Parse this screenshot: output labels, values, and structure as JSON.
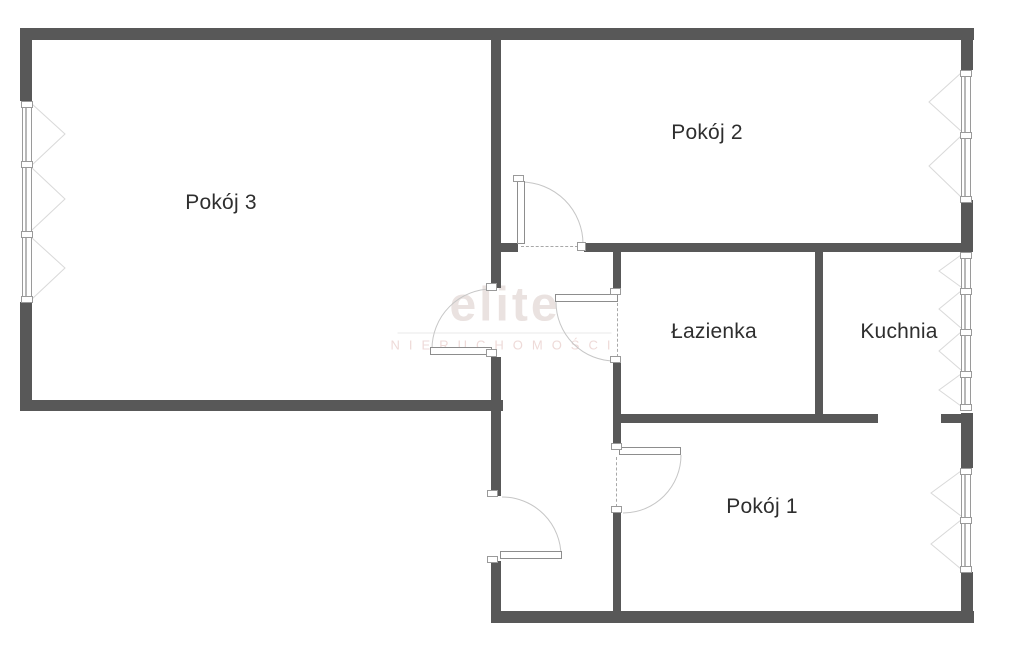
{
  "canvas": {
    "width": 1024,
    "height": 652,
    "background": "#ffffff"
  },
  "colors": {
    "wall": "#585858",
    "frame": "#9a9a9a",
    "leaf_border": "#8d8d8d",
    "door_arc": "#c6c6c6",
    "casement_line": "#d9d9d9",
    "dash": "#a8a8a8",
    "label": "#2e2e2e",
    "watermark_brand": "#eae2e0",
    "watermark_subtitle": "#eedad8",
    "watermark_line": "#e9e9e9"
  },
  "rooms": [
    {
      "id": "pokoj-3",
      "label": "Pokój 3",
      "label_x": 221,
      "label_y": 203
    },
    {
      "id": "pokoj-2",
      "label": "Pokój 2",
      "label_x": 707,
      "label_y": 133
    },
    {
      "id": "lazienka",
      "label": "Łazienka",
      "label_x": 714,
      "label_y": 332
    },
    {
      "id": "kuchnia",
      "label": "Kuchnia",
      "label_x": 899,
      "label_y": 332
    },
    {
      "id": "pokoj-1",
      "label": "Pokój 1",
      "label_x": 762,
      "label_y": 507
    }
  ],
  "watermark": {
    "brand": "elite",
    "subtitle": "NIERUCHOMOŚCI",
    "x": 505,
    "y": 317,
    "line_width": 214
  },
  "plan": {
    "walls": [
      {
        "x": 20,
        "y": 28,
        "w": 954,
        "h": 12
      },
      {
        "x": 20,
        "y": 28,
        "w": 12,
        "h": 73
      },
      {
        "x": 20,
        "y": 302,
        "w": 12,
        "h": 109
      },
      {
        "x": 20,
        "y": 400,
        "w": 483,
        "h": 11
      },
      {
        "x": 491,
        "y": 39,
        "w": 10,
        "h": 249
      },
      {
        "x": 491,
        "y": 357,
        "w": 10,
        "h": 139
      },
      {
        "x": 491,
        "y": 561,
        "w": 10,
        "h": 62
      },
      {
        "x": 501,
        "y": 243,
        "w": 17,
        "h": 9
      },
      {
        "x": 584,
        "y": 243,
        "w": 377,
        "h": 9
      },
      {
        "x": 613,
        "y": 252,
        "w": 8,
        "h": 43
      },
      {
        "x": 613,
        "y": 361,
        "w": 8,
        "h": 88
      },
      {
        "x": 613,
        "y": 512,
        "w": 8,
        "h": 99
      },
      {
        "x": 815,
        "y": 252,
        "w": 8,
        "h": 163
      },
      {
        "x": 613,
        "y": 414,
        "w": 265,
        "h": 9
      },
      {
        "x": 941,
        "y": 414,
        "w": 32,
        "h": 9
      },
      {
        "x": 961,
        "y": 28,
        "w": 12,
        "h": 42
      },
      {
        "x": 961,
        "y": 200,
        "w": 12,
        "h": 52
      },
      {
        "x": 961,
        "y": 413,
        "w": 12,
        "h": 55
      },
      {
        "x": 961,
        "y": 572,
        "w": 12,
        "h": 51
      },
      {
        "x": 491,
        "y": 611,
        "w": 483,
        "h": 12
      }
    ],
    "windows": [
      {
        "x": 22,
        "y": 101,
        "w": 10,
        "h": 201,
        "mullions": [
          101,
          161,
          231,
          296
        ]
      },
      {
        "x": 961,
        "y": 70,
        "w": 10,
        "h": 130,
        "mullions": [
          70,
          132,
          196
        ]
      },
      {
        "x": 961,
        "y": 252,
        "w": 10,
        "h": 158,
        "mullions": [
          252,
          288,
          329,
          371,
          404
        ]
      },
      {
        "x": 961,
        "y": 468,
        "w": 10,
        "h": 104,
        "mullions": [
          468,
          517,
          566
        ]
      }
    ],
    "casements": [
      "32,104 65,134 32,165",
      "32,168 65,199 32,230",
      "32,238 65,268 32,299",
      "961,73 929,102 961,131",
      "961,136 929,166 961,197",
      "961,255 939,271 961,287",
      "961,291 939,309 961,328",
      "961,332 939,351 961,370",
      "961,374 939,390 961,406",
      "961,471 931,493 961,516",
      "961,520 931,544 961,569"
    ],
    "doors": [
      {
        "name": "pokoj-2-door",
        "leaf": {
          "x": 517,
          "y": 181,
          "w": 8,
          "h": 63
        },
        "jambs": [
          {
            "x": 513,
            "y": 175,
            "w": 11,
            "h": 7
          },
          {
            "x": 577,
            "y": 242,
            "w": 9,
            "h": 9
          }
        ],
        "dash": {
          "dir": "h",
          "x": 521,
          "y": 246,
          "len": 57
        },
        "arc": "M583,244 A62,62 0 0 0 521,182"
      },
      {
        "name": "pokoj-3-door",
        "leaf": {
          "x": 430,
          "y": 347,
          "w": 62,
          "h": 8
        },
        "jambs": [
          {
            "x": 486,
            "y": 283,
            "w": 11,
            "h": 8
          },
          {
            "x": 486,
            "y": 349,
            "w": 11,
            "h": 8
          }
        ],
        "arc": "M492,289 A60,60 0 0 0 432,349"
      },
      {
        "name": "lazienka-door",
        "leaf": {
          "x": 555,
          "y": 294,
          "w": 63,
          "h": 8
        },
        "jambs": [
          {
            "x": 610,
            "y": 288,
            "w": 11,
            "h": 7
          },
          {
            "x": 610,
            "y": 356,
            "w": 11,
            "h": 7
          }
        ],
        "dash": {
          "dir": "v",
          "x": 617,
          "y": 303,
          "len": 54
        },
        "arc": "M556,302 A59,59 0 0 0 615,361"
      },
      {
        "name": "entrance-door",
        "leaf": {
          "x": 500,
          "y": 551,
          "w": 62,
          "h": 8
        },
        "jambs": [
          {
            "x": 487,
            "y": 490,
            "w": 11,
            "h": 7
          },
          {
            "x": 487,
            "y": 556,
            "w": 11,
            "h": 7
          }
        ],
        "arc": "M502,497 A59,59 0 0 1 561,556"
      },
      {
        "name": "pokoj-1-door",
        "leaf": {
          "x": 619,
          "y": 447,
          "w": 62,
          "h": 8
        },
        "jambs": [
          {
            "x": 611,
            "y": 443,
            "w": 11,
            "h": 7
          },
          {
            "x": 611,
            "y": 506,
            "w": 11,
            "h": 7
          }
        ],
        "dash": {
          "dir": "v",
          "x": 616,
          "y": 457,
          "len": 50
        },
        "arc": "M681,455 A58,58 0 0 1 623,513"
      }
    ]
  }
}
